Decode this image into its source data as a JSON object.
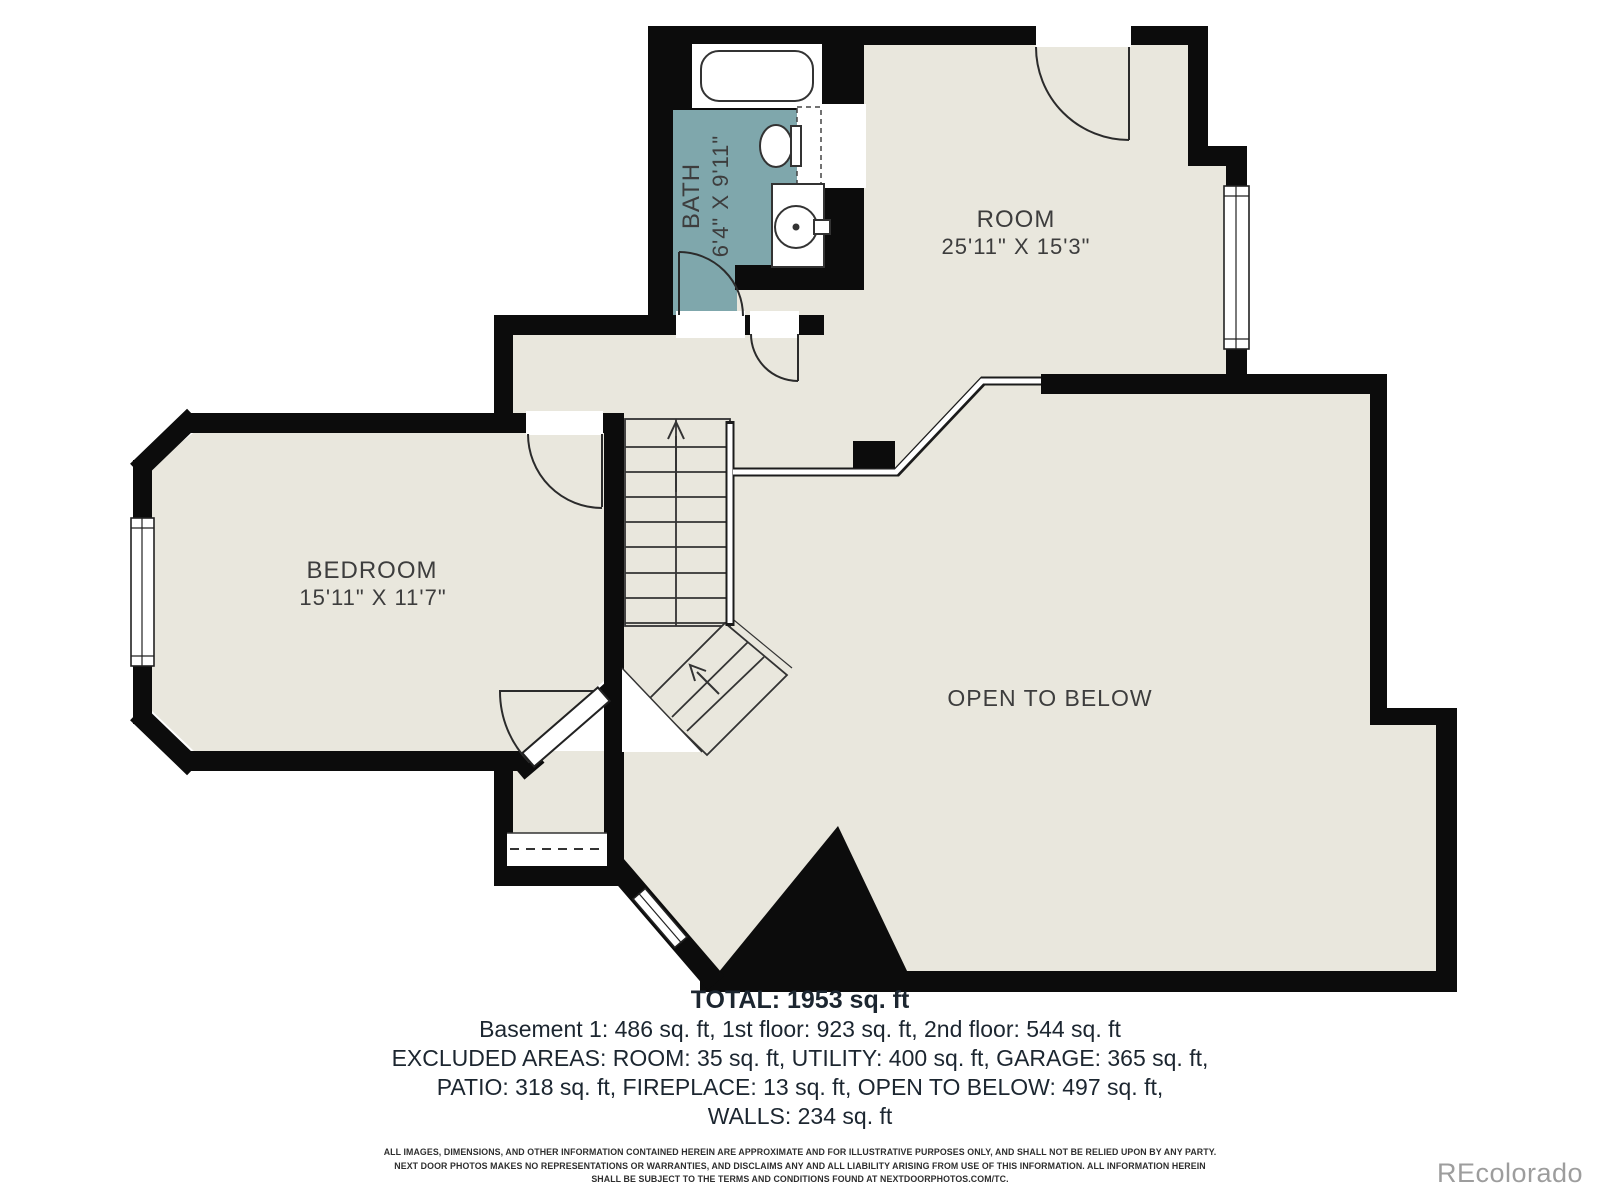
{
  "plan": {
    "bath": {
      "label": "BATH",
      "dims": "6'4\" X 9'11\""
    },
    "room": {
      "label": "ROOM",
      "dims": "25'11\" X 15'3\""
    },
    "bedroom": {
      "label": "BEDROOM",
      "dims": "15'11\" X 11'7\""
    },
    "open": {
      "label": "OPEN TO BELOW"
    }
  },
  "summary": {
    "total": "TOTAL: 1953 sq. ft",
    "line1": "Basement 1: 486 sq. ft, 1st floor: 923 sq. ft, 2nd floor: 544 sq. ft",
    "line2": "EXCLUDED AREAS: ROOM: 35 sq. ft, UTILITY: 400 sq. ft, GARAGE: 365 sq. ft,",
    "line3": "PATIO: 318 sq. ft, FIREPLACE: 13 sq. ft, OPEN TO BELOW: 497 sq. ft,",
    "line4": "WALLS: 234 sq. ft"
  },
  "disclaimer": {
    "line1": "ALL IMAGES, DIMENSIONS, AND OTHER INFORMATION CONTAINED HEREIN ARE APPROXIMATE AND FOR ILLUSTRATIVE PURPOSES ONLY, AND SHALL NOT BE RELIED UPON BY ANY PARTY.",
    "line2": "NEXT DOOR PHOTOS MAKES NO REPRESENTATIONS OR WARRANTIES, AND DISCLAIMS ANY AND ALL LIABILITY ARISING FROM USE OF THIS INFORMATION. ALL INFORMATION HEREIN",
    "line3": "SHALL BE SUBJECT TO THE TERMS AND CONDITIONS FOUND AT NEXTDOORPHOTOS.COM/TC."
  },
  "watermark": "REcolorado",
  "colors": {
    "floor": "#e9e7dd",
    "bath": "#7fa7ac",
    "wall": "#0c0c0c",
    "line": "#2b2b2b"
  }
}
